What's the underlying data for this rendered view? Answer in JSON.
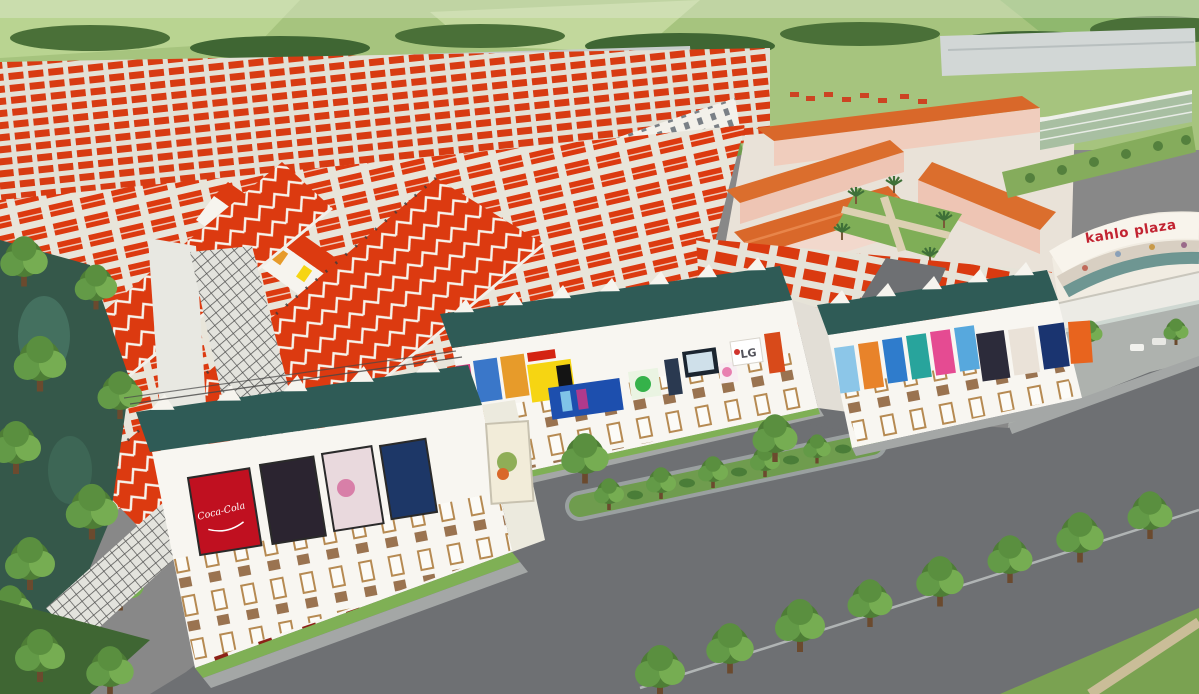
{
  "scene": {
    "description": "Aerial 3D rendering of a shophouse and townhouse real-estate development: dense rows of red-roofed townhouses, three white shophouse blocks with dark-teal awnings covered in advertising billboards, a pink school campus with terracotta roofs, the curved kahlo plaza mall, gray asphalt roads with tree-lined medians, and a tree-covered canal on the left",
    "colors": {
      "roof_red": "#dc3a10",
      "awning_teal": "#2f5b56",
      "facade_white": "#f8f6f1",
      "window_frame": "#b68a52",
      "road_gray": "#6e7073",
      "sidewalk_gray": "#a4a7a6",
      "grass_green": "#7fb055",
      "field_green": "#a6c47e",
      "tree_green": "#4e7d36",
      "water_green": "#35584a",
      "school_roof_orange": "#d9682a",
      "school_wall_pink": "#eec5b4",
      "plaza_text_red": "#c22331"
    },
    "mini_billboards": [
      "#d6357d",
      "#3a77c9",
      "#e79b2a",
      "#f6d512",
      "#35b24a",
      "#7ec4e8"
    ]
  },
  "signs": {
    "plaza_name": "kahlo plaza",
    "lg_label": "LG",
    "coca_label": "Coca-Cola"
  },
  "billboards": {
    "front_block": [
      {
        "name": "coca-cola-billboard",
        "color": "#c01020"
      },
      {
        "name": "movie-poster-dark",
        "color": "#2b2430"
      },
      {
        "name": "fashion-poster-light",
        "color": "#e9d9dd"
      },
      {
        "name": "movie-poster-navy",
        "color": "#1d3767"
      },
      {
        "name": "food-poster-white",
        "color": "#f2ecd9"
      }
    ],
    "middle_block": [
      {
        "name": "magenta-poster",
        "color": "#d6357d"
      },
      {
        "name": "phone-poster-blue",
        "color": "#3a77c9"
      },
      {
        "name": "juice-poster-orange",
        "color": "#e79b2a"
      },
      {
        "name": "red-banner",
        "color": "#d42412"
      },
      {
        "name": "mobile-store-banner-yellow",
        "color": "#f6d512"
      },
      {
        "name": "black-strip-banner",
        "color": "#141414"
      },
      {
        "name": "samsung-billboard-blue",
        "color": "#1d4fae"
      },
      {
        "name": "green-mascot-poster",
        "color": "#eaf4e2"
      },
      {
        "name": "phone-display-poster",
        "color": "#2a3950"
      },
      {
        "name": "tv-screen-billboard",
        "color": "#1b2530"
      },
      {
        "name": "ice-cream-poster",
        "color": "#f7eef2"
      },
      {
        "name": "lg-sign",
        "color": "#ffffff"
      },
      {
        "name": "orange-vertical-banner",
        "color": "#d84a1a"
      }
    ],
    "right_block": [
      {
        "name": "sky-blue-poster",
        "color": "#8cc6e8"
      },
      {
        "name": "orange-splash-poster",
        "color": "#e8832a"
      },
      {
        "name": "blue-poster",
        "color": "#2f7ccc"
      },
      {
        "name": "teal-poster",
        "color": "#28a49c"
      },
      {
        "name": "pink-poster",
        "color": "#e54b92"
      },
      {
        "name": "light-blue-poster",
        "color": "#57a8dd"
      },
      {
        "name": "movie-poster-dark",
        "color": "#2c2b3a"
      },
      {
        "name": "portrait-poster-light",
        "color": "#eae2d8"
      },
      {
        "name": "navy-poster",
        "color": "#1a3470"
      },
      {
        "name": "food-poster-orange",
        "color": "#e8641e"
      }
    ]
  }
}
